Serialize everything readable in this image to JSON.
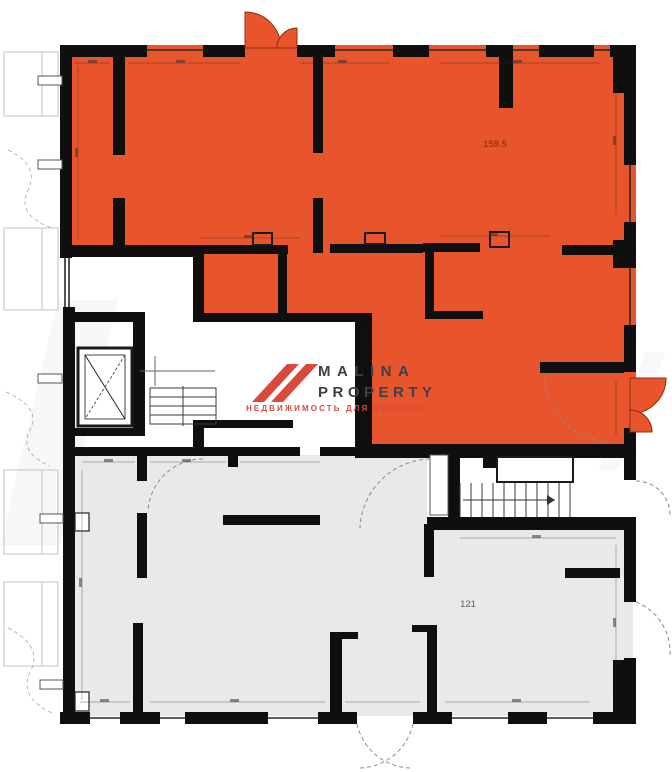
{
  "plan": {
    "unit_top_label": "159.5",
    "unit_bottom_label": "121",
    "unit_top_color": "#e8542c",
    "unit_bottom_color": "#e9e9e9",
    "wall_color": "#0f0f0f",
    "door_arc_color": "#e8542c"
  },
  "logo": {
    "line1": "MALINA",
    "line2": "PROPERTY",
    "tagline": "НЕДВИЖИМОСТЬ ДЛЯ БИЗНЕСА",
    "accent": "#d84a3c",
    "text_color": "#3a4247"
  }
}
